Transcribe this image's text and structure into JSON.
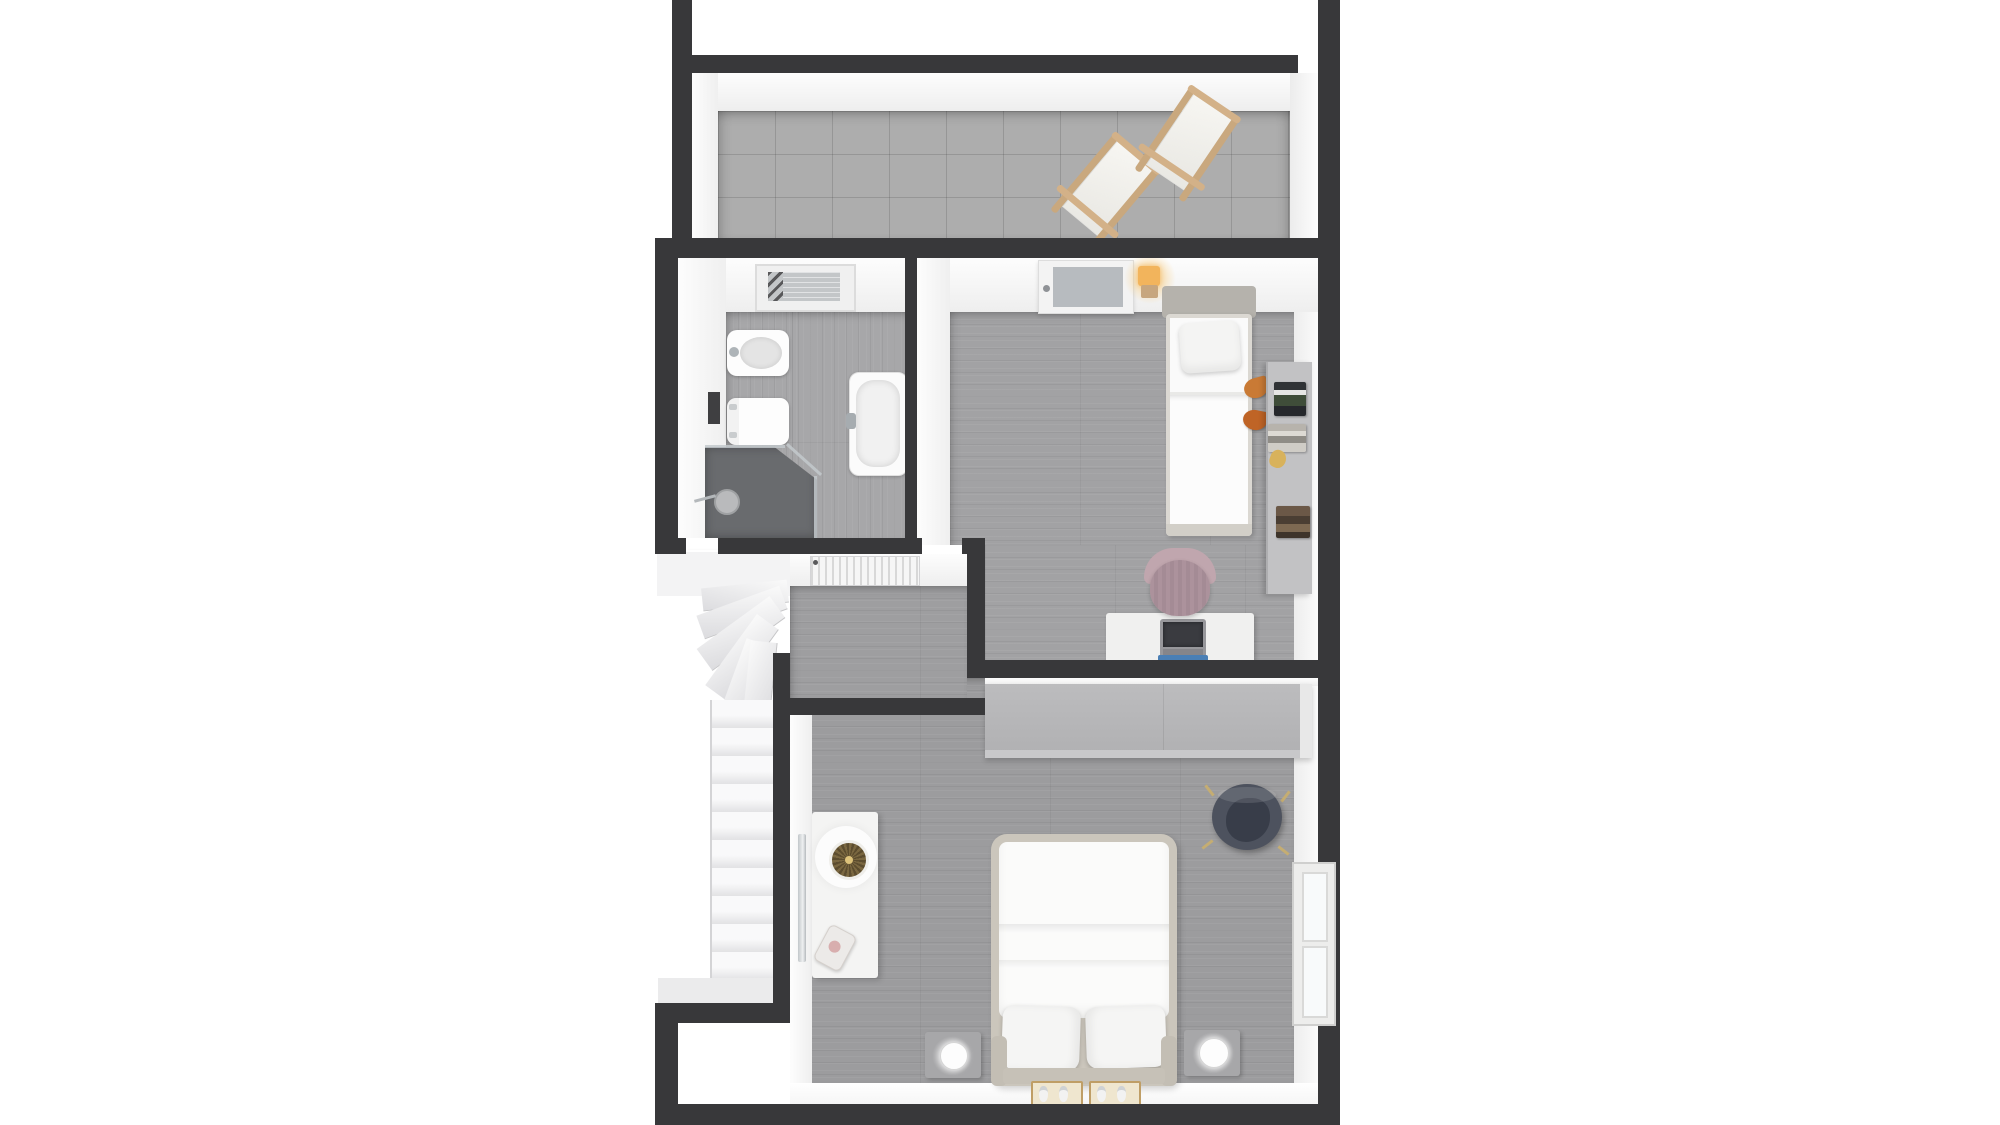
{
  "meta": {
    "description": "3D rendered top-down dollhouse floor plan of an upper storey, no text labels visible",
    "view": "orthographic top-down render on white background"
  },
  "palette": {
    "wall_cut": "#38383a",
    "wall_face": "#f5f5f5",
    "wood_floor": "#a2a2a4",
    "terrace_tile": "#adadad",
    "shower_floor": "#696b6e",
    "lamp_glow_amber": "#f2b45c",
    "desk_chair_mauve": "#b89da6",
    "armchair_navy": "#4d525e",
    "deck_chair_wood": "#c9a87e",
    "wardrobe_gray": "#b6b6b8",
    "book_green": "#3f4d39",
    "valet_orange": "#c97a35",
    "gold_accent": "#d8b25c",
    "folder_blue": "#4a7fb5"
  },
  "rooms": {
    "terrace": {
      "label": "Terrace",
      "floor": "large stone tiles",
      "furniture": [
        "deck-chair",
        "deck-chair"
      ]
    },
    "bathroom": {
      "label": "Bathroom",
      "floor": "wood planks",
      "fixtures": [
        "skylight-window-with-blind",
        "wall-niche",
        "bidet",
        "toilet",
        "bathtub",
        "walk-in-shower",
        "shower-head",
        "glass-screen",
        "open-door-leaf"
      ]
    },
    "kids_bedroom": {
      "label": "Bedroom 2",
      "floor": "wood planks",
      "furniture": [
        "terrace-door",
        "wall-lamp",
        "single-bed",
        "pillow",
        "clothes-valet",
        "wall-shelf-unit",
        "book-stack",
        "book-stack",
        "gold-decor",
        "book-stack",
        "desk",
        "laptop",
        "blue-folder",
        "desk-chair"
      ]
    },
    "hall": {
      "label": "Landing hall",
      "floor": "wood planks",
      "furniture": [
        "radiator"
      ]
    },
    "staircase": {
      "label": "Staircase",
      "details": [
        "top-landing",
        "winder-treads",
        "straight-flight",
        "bottom-landing"
      ]
    },
    "master_bedroom": {
      "label": "Master bedroom",
      "floor": "wood planks",
      "furniture": [
        "built-in-wardrobe",
        "armchair",
        "double-bed",
        "pillow",
        "pillow",
        "nightstand",
        "nightstand",
        "table-lamp",
        "table-lamp",
        "slipper-mat",
        "slipper-mat",
        "vanity-table",
        "round-decor-plate",
        "stool",
        "leaning-mirror",
        "window"
      ]
    }
  }
}
